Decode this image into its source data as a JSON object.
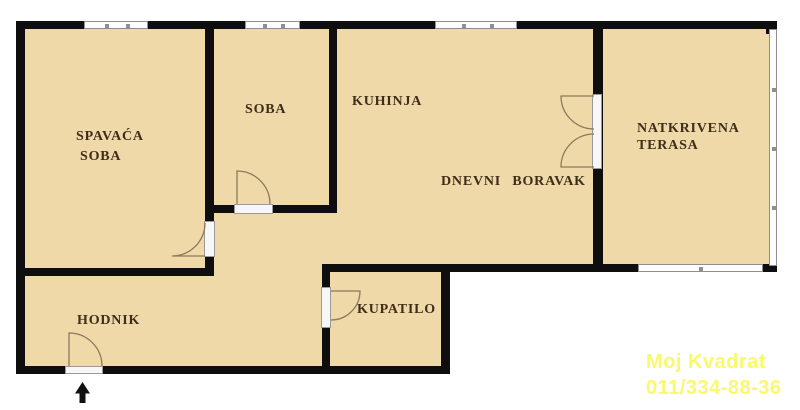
{
  "plan_title": "apartment floor plan",
  "rooms": {
    "spavaca": {
      "line1": "SPAVAĆA",
      "line2": "SOBA"
    },
    "soba": {
      "label": "SOBA"
    },
    "kuhinja": {
      "label": "KUHINJA"
    },
    "dnevni": {
      "label": "DNEVNI BORAVAK"
    },
    "terasa": {
      "line1": "NATKRIVENA",
      "line2": "TERASA"
    },
    "hodnik": {
      "label": "HODNIK"
    },
    "kupatilo": {
      "label": "KUPATILO"
    }
  },
  "watermark": {
    "line1": "Moj Kvadrat",
    "line2": "011/334-88-36"
  },
  "colors": {
    "room_fill": "#EFD9A9",
    "wall": "#0E0E0E",
    "label_text": "#3E2D18",
    "watermark": "#FAF96B",
    "door_arc": "#8B7B5C"
  }
}
